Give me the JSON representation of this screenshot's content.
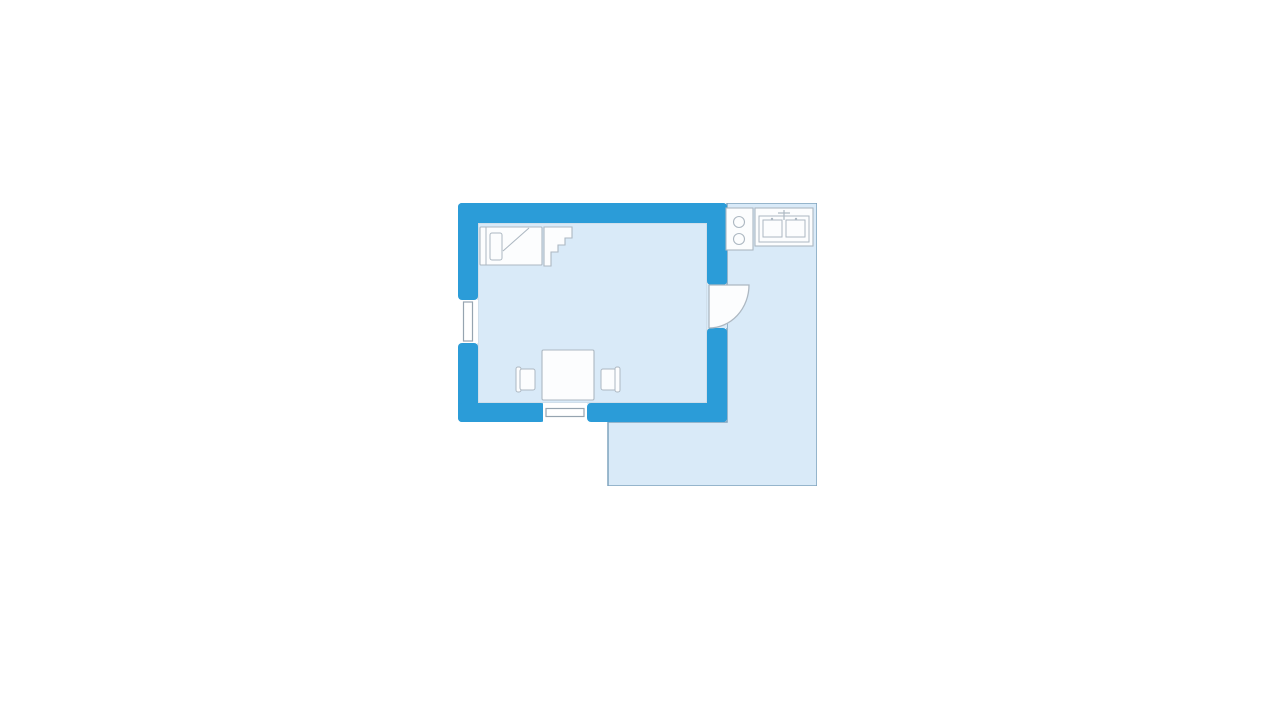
{
  "page": {
    "background_color": "#ffffff"
  },
  "colors": {
    "page_bg": "#ffffff",
    "wall": "#2B9CD8",
    "area_fill": "#D9EAF8",
    "terrace_border": "#7FA3BE",
    "interior_border": "#C8D4DE",
    "fixture_stroke": "#ADB8C2",
    "fixture_fill": "#FCFDFE",
    "window_stroke": "#96A4B0",
    "gap_fill": "#FFFFFF"
  },
  "floorplan": {
    "type": "studio-apartment-floor-plan",
    "elements": [
      {
        "name": "terrace",
        "kind": "outdoor-area"
      },
      {
        "name": "main-room",
        "kind": "room"
      },
      {
        "name": "bed",
        "kind": "furniture"
      },
      {
        "name": "stairs",
        "kind": "fixture"
      },
      {
        "name": "dining-table",
        "kind": "furniture"
      },
      {
        "name": "chair-left",
        "kind": "furniture"
      },
      {
        "name": "chair-right",
        "kind": "furniture"
      },
      {
        "name": "door",
        "kind": "opening"
      },
      {
        "name": "window-left",
        "kind": "opening"
      },
      {
        "name": "window-bottom",
        "kind": "opening"
      },
      {
        "name": "stove-hob",
        "kind": "kitchen-fixture"
      },
      {
        "name": "kitchen-sink",
        "kind": "kitchen-fixture"
      }
    ]
  }
}
